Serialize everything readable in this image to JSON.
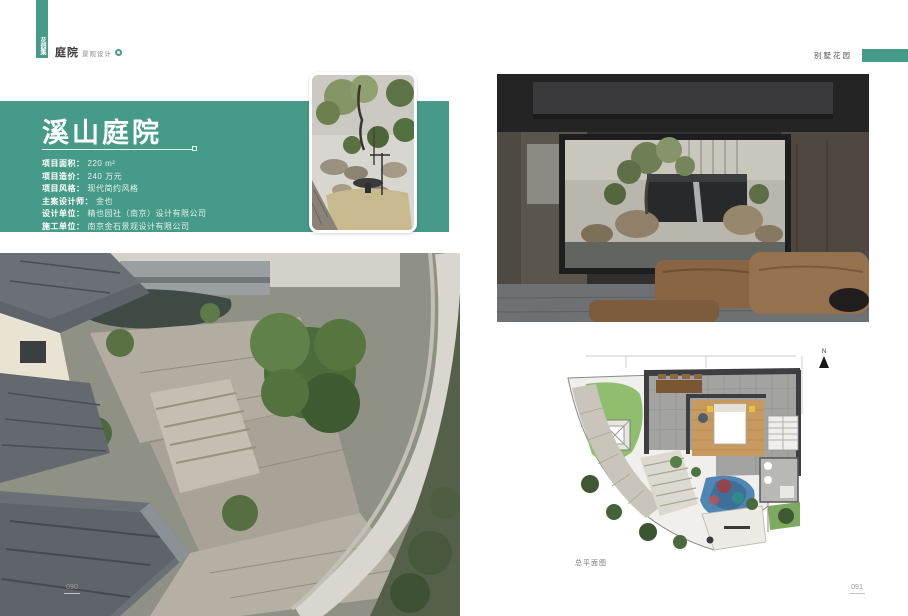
{
  "brand": {
    "logo_vertical": "花园集",
    "name_bold": "庭院",
    "name_small": "景观设计"
  },
  "header_right": {
    "label": "别墅花园"
  },
  "title_block": {
    "title": "溪山庭院",
    "info": [
      {
        "label": "项目面积：",
        "value": "220 m²"
      },
      {
        "label": "项目造价：",
        "value": "240 万元"
      },
      {
        "label": "项目风格：",
        "value": "现代简约风格"
      },
      {
        "label": "主案设计师：",
        "value": "金也"
      },
      {
        "label": "设计单位：",
        "value": "精也园社（南京）设计有限公司"
      },
      {
        "label": "施工单位：",
        "value": "南京金石景观设计有限公司"
      }
    ]
  },
  "plan": {
    "caption": "总平面图",
    "north_label": "N"
  },
  "pages": {
    "left_number": "090",
    "right_number": "091"
  },
  "colors": {
    "accent_green": "#469b88",
    "roof_gray": "#646a70",
    "lawn_green": "#8fbf6e",
    "pool_blue": "#4f86b3"
  }
}
